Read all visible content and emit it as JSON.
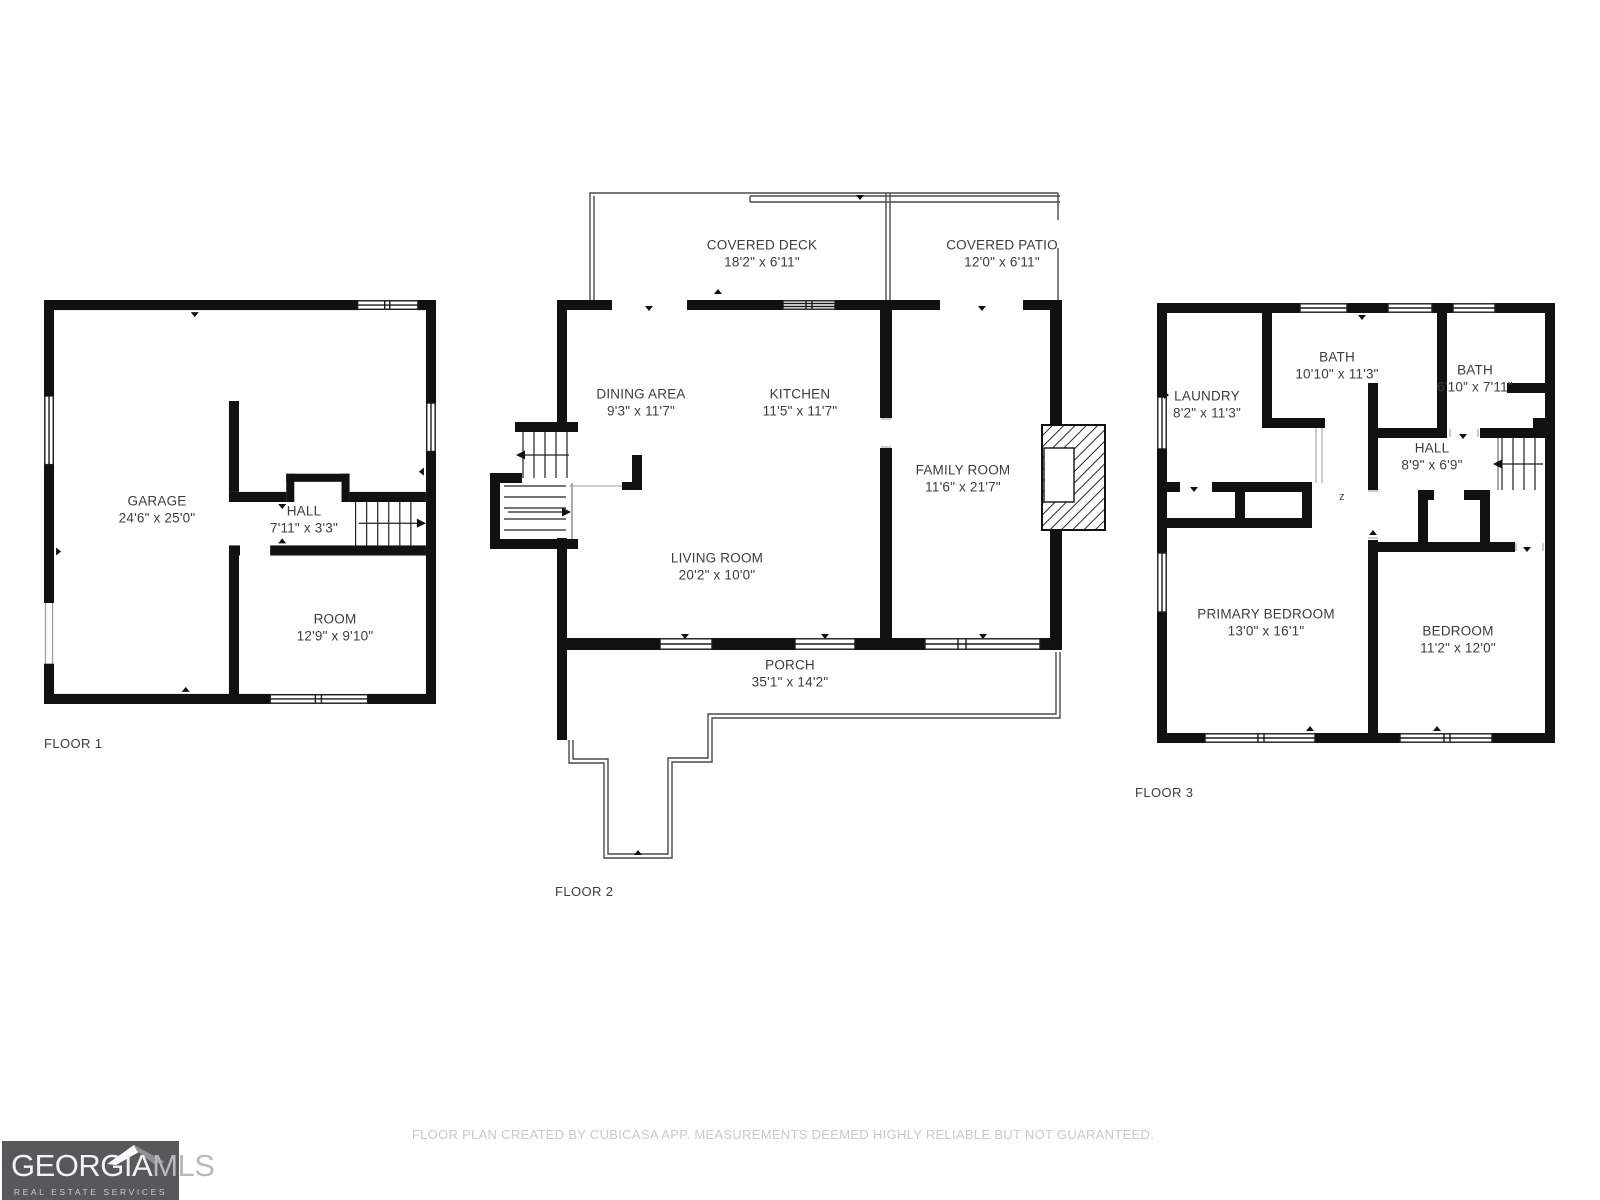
{
  "floors": [
    {
      "label": "FLOOR 1",
      "rooms": [
        {
          "name": "GARAGE",
          "dims": "24'6\" x 25'0\""
        },
        {
          "name": "HALL",
          "dims": "7'11\" x 3'3\""
        },
        {
          "name": "ROOM",
          "dims": "12'9\" x 9'10\""
        }
      ]
    },
    {
      "label": "FLOOR 2",
      "rooms": [
        {
          "name": "COVERED DECK",
          "dims": "18'2\" x 6'11\""
        },
        {
          "name": "COVERED PATIO",
          "dims": "12'0\" x 6'11\""
        },
        {
          "name": "DINING AREA",
          "dims": "9'3\" x 11'7\""
        },
        {
          "name": "KITCHEN",
          "dims": "11'5\" x 11'7\""
        },
        {
          "name": "FAMILY ROOM",
          "dims": "11'6\" x 21'7\""
        },
        {
          "name": "LIVING ROOM",
          "dims": "20'2\" x 10'0\""
        },
        {
          "name": "PORCH",
          "dims": "35'1\" x 14'2\""
        }
      ]
    },
    {
      "label": "FLOOR 3",
      "rooms": [
        {
          "name": "LAUNDRY",
          "dims": "8'2\" x 11'3\""
        },
        {
          "name": "BATH",
          "dims": "10'10\" x 11'3\""
        },
        {
          "name": "BATH",
          "dims": "6'10\" x 7'11\""
        },
        {
          "name": "HALL",
          "dims": "8'9\" x 6'9\""
        },
        {
          "name": "PRIMARY BEDROOM",
          "dims": "13'0\" x 16'1\""
        },
        {
          "name": "BEDROOM",
          "dims": "11'2\" x 12'0\""
        }
      ]
    }
  ],
  "footer": {
    "disclaimer": "FLOOR PLAN CREATED BY CUBICASA APP. MEASUREMENTS DEEMED HIGHLY RELIABLE BUT NOT GUARANTEED."
  },
  "logo": {
    "brand_primary": "GEORGIA",
    "brand_secondary": "MLS",
    "tagline": "REAL ESTATE SERVICES",
    "background_color": "#57585A"
  },
  "plan": {
    "door_marker": "z",
    "wall_color": "#111111",
    "thin_line_color": "#4A4A4A"
  }
}
